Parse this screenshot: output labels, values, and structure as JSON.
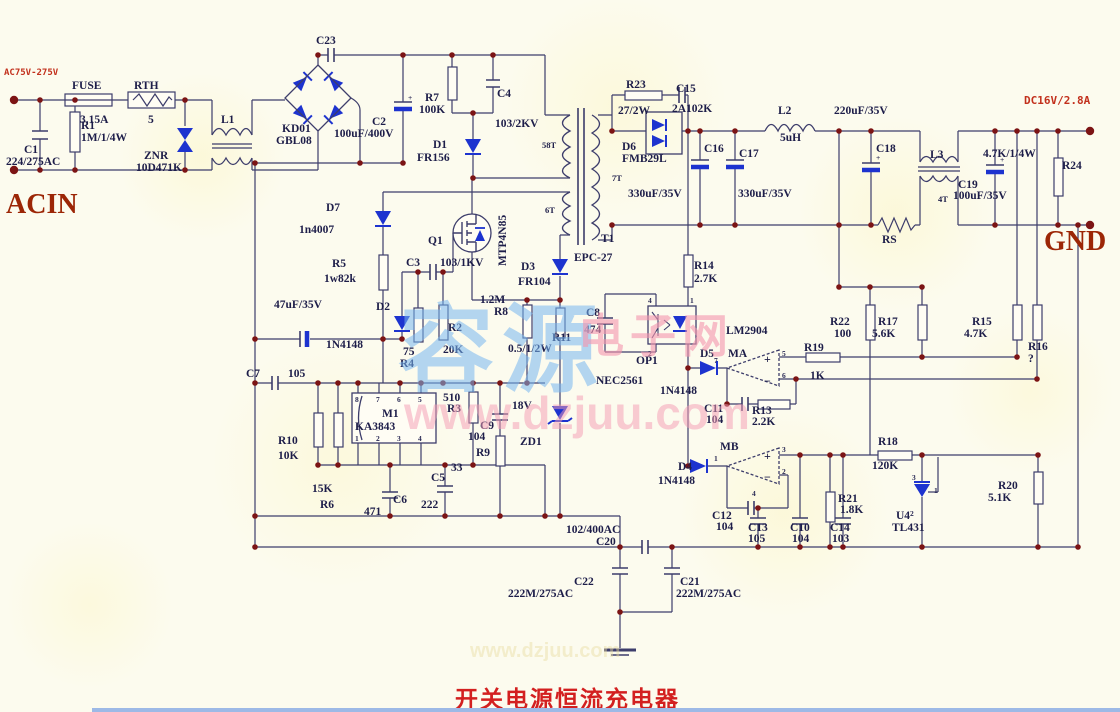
{
  "meta": {
    "title": "开关电源恒流充电器"
  },
  "watermark": {
    "cn1": "容源",
    "cn2": "电子网",
    "url": "www.dzjuu.com",
    "url_faint": "www.dzjuu.com"
  },
  "labels": [
    {
      "t": "AC75V-275V",
      "x": 4,
      "y": 75,
      "c": "rs"
    },
    {
      "t": "ACIN",
      "x": 6,
      "y": 213,
      "c": "rb"
    },
    {
      "t": "GND",
      "x": 1044,
      "y": 250,
      "c": "rb"
    },
    {
      "t": "DC16V/2.8A",
      "x": 1024,
      "y": 104,
      "c": "rs2"
    },
    {
      "t": "FUSE",
      "x": 72,
      "y": 89,
      "c": "c"
    },
    {
      "t": "3.15A",
      "x": 80,
      "y": 123,
      "c": "c"
    },
    {
      "t": "RTH",
      "x": 134,
      "y": 89,
      "c": "c"
    },
    {
      "t": "5",
      "x": 148,
      "y": 123,
      "c": "c"
    },
    {
      "t": "C1",
      "x": 24,
      "y": 153,
      "c": "c"
    },
    {
      "t": "224/275AC",
      "x": 6,
      "y": 165,
      "c": "c"
    },
    {
      "t": "R1",
      "x": 81,
      "y": 129,
      "c": "c"
    },
    {
      "t": "1M/1/4W",
      "x": 81,
      "y": 141,
      "c": "c"
    },
    {
      "t": "ZNR",
      "x": 144,
      "y": 159,
      "c": "c"
    },
    {
      "t": "10D471K",
      "x": 136,
      "y": 171,
      "c": "c"
    },
    {
      "t": "L1",
      "x": 221,
      "y": 123,
      "c": "c"
    },
    {
      "t": "C23",
      "x": 316,
      "y": 44,
      "c": "c"
    },
    {
      "t": "KD01",
      "x": 282,
      "y": 132,
      "c": "c"
    },
    {
      "t": "GBL08",
      "x": 276,
      "y": 144,
      "c": "c"
    },
    {
      "t": "C2",
      "x": 372,
      "y": 125,
      "c": "c"
    },
    {
      "t": "100uF/400V",
      "x": 334,
      "y": 137,
      "c": "c"
    },
    {
      "t": "R7",
      "x": 425,
      "y": 101,
      "c": "c"
    },
    {
      "t": "100K",
      "x": 419,
      "y": 113,
      "c": "c"
    },
    {
      "t": "C4",
      "x": 497,
      "y": 97,
      "c": "c"
    },
    {
      "t": "103/2KV",
      "x": 495,
      "y": 127,
      "c": "c"
    },
    {
      "t": "D1",
      "x": 433,
      "y": 148,
      "c": "c"
    },
    {
      "t": "FR156",
      "x": 417,
      "y": 161,
      "c": "c"
    },
    {
      "t": "D7",
      "x": 326,
      "y": 211,
      "c": "c"
    },
    {
      "t": "1n4007",
      "x": 299,
      "y": 233,
      "c": "c"
    },
    {
      "t": "R5",
      "x": 332,
      "y": 267,
      "c": "c"
    },
    {
      "t": "1w82k",
      "x": 324,
      "y": 282,
      "c": "c"
    },
    {
      "t": "47uF/35V",
      "x": 274,
      "y": 308,
      "c": "c"
    },
    {
      "t": "D2",
      "x": 376,
      "y": 310,
      "c": "c"
    },
    {
      "t": "1N4148",
      "x": 326,
      "y": 348,
      "c": "c"
    },
    {
      "t": "C3",
      "x": 406,
      "y": 266,
      "c": "c"
    },
    {
      "t": "103/1KV",
      "x": 440,
      "y": 266,
      "c": "c"
    },
    {
      "t": "Q1",
      "x": 428,
      "y": 244,
      "c": "c"
    },
    {
      "t": "MTP4N85",
      "x": 506,
      "y": 266,
      "c": "c",
      "r": -90
    },
    {
      "t": "1.2M",
      "x": 480,
      "y": 303,
      "c": "c"
    },
    {
      "t": "R8",
      "x": 494,
      "y": 315,
      "c": "c"
    },
    {
      "t": "R2",
      "x": 448,
      "y": 331,
      "c": "c"
    },
    {
      "t": "20K",
      "x": 443,
      "y": 353,
      "c": "c"
    },
    {
      "t": "75",
      "x": 403,
      "y": 355,
      "c": "c"
    },
    {
      "t": "R4",
      "x": 400,
      "y": 367,
      "c": "c"
    },
    {
      "t": "R11",
      "x": 552,
      "y": 341,
      "c": "c"
    },
    {
      "t": "0.5/1/2W",
      "x": 508,
      "y": 352,
      "c": "c"
    },
    {
      "t": "D3",
      "x": 521,
      "y": 270,
      "c": "c"
    },
    {
      "t": "FR104",
      "x": 518,
      "y": 285,
      "c": "c"
    },
    {
      "t": "58T",
      "x": 542,
      "y": 148,
      "c": "s"
    },
    {
      "t": "6T",
      "x": 545,
      "y": 213,
      "c": "s"
    },
    {
      "t": "7T",
      "x": 612,
      "y": 181,
      "c": "s"
    },
    {
      "t": "T1",
      "x": 601,
      "y": 242,
      "c": "c"
    },
    {
      "t": "EPC-27",
      "x": 574,
      "y": 261,
      "c": "c"
    },
    {
      "t": "C7",
      "x": 246,
      "y": 377,
      "c": "c"
    },
    {
      "t": "105",
      "x": 288,
      "y": 377,
      "c": "c"
    },
    {
      "t": "R10",
      "x": 278,
      "y": 444,
      "c": "c"
    },
    {
      "t": "10K",
      "x": 278,
      "y": 459,
      "c": "c"
    },
    {
      "t": "15K",
      "x": 312,
      "y": 492,
      "c": "c"
    },
    {
      "t": "R6",
      "x": 320,
      "y": 508,
      "c": "c"
    },
    {
      "t": "M1",
      "x": 382,
      "y": 417,
      "c": "c"
    },
    {
      "t": "KA3843",
      "x": 355,
      "y": 430,
      "c": "c"
    },
    {
      "t": "C6",
      "x": 393,
      "y": 503,
      "c": "c"
    },
    {
      "t": "471",
      "x": 364,
      "y": 515,
      "c": "c"
    },
    {
      "t": "C5",
      "x": 431,
      "y": 481,
      "c": "c"
    },
    {
      "t": "222",
      "x": 421,
      "y": 508,
      "c": "c"
    },
    {
      "t": "510",
      "x": 443,
      "y": 401,
      "c": "c"
    },
    {
      "t": "R3",
      "x": 447,
      "y": 412,
      "c": "c"
    },
    {
      "t": "C9",
      "x": 480,
      "y": 429,
      "c": "c"
    },
    {
      "t": "104",
      "x": 468,
      "y": 440,
      "c": "c"
    },
    {
      "t": "R9",
      "x": 476,
      "y": 456,
      "c": "c"
    },
    {
      "t": "33",
      "x": 451,
      "y": 471,
      "c": "c"
    },
    {
      "t": "18V",
      "x": 512,
      "y": 409,
      "c": "c"
    },
    {
      "t": "ZD1",
      "x": 520,
      "y": 445,
      "c": "c"
    },
    {
      "t": "102/400AC",
      "x": 566,
      "y": 533,
      "c": "c"
    },
    {
      "t": "C20",
      "x": 596,
      "y": 545,
      "c": "c"
    },
    {
      "t": "C22",
      "x": 574,
      "y": 585,
      "c": "c"
    },
    {
      "t": "222M/275AC",
      "x": 508,
      "y": 597,
      "c": "c"
    },
    {
      "t": "C21",
      "x": 680,
      "y": 585,
      "c": "c"
    },
    {
      "t": "222M/275AC",
      "x": 676,
      "y": 597,
      "c": "c"
    },
    {
      "t": "R23",
      "x": 626,
      "y": 88,
      "c": "c"
    },
    {
      "t": "27/2W",
      "x": 618,
      "y": 114,
      "c": "c"
    },
    {
      "t": "C15",
      "x": 676,
      "y": 92,
      "c": "c"
    },
    {
      "t": "2A102K",
      "x": 672,
      "y": 112,
      "c": "c"
    },
    {
      "t": "D6",
      "x": 622,
      "y": 150,
      "c": "c"
    },
    {
      "t": "FMB29L",
      "x": 622,
      "y": 162,
      "c": "c"
    },
    {
      "t": "C16",
      "x": 704,
      "y": 152,
      "c": "c"
    },
    {
      "t": "330uF/35V",
      "x": 628,
      "y": 197,
      "c": "c"
    },
    {
      "t": "C17",
      "x": 739,
      "y": 157,
      "c": "c"
    },
    {
      "t": "330uF/35V",
      "x": 738,
      "y": 197,
      "c": "c"
    },
    {
      "t": "L2",
      "x": 778,
      "y": 114,
      "c": "c"
    },
    {
      "t": "5uH",
      "x": 780,
      "y": 141,
      "c": "c"
    },
    {
      "t": "220uF/35V",
      "x": 834,
      "y": 114,
      "c": "c"
    },
    {
      "t": "C18",
      "x": 876,
      "y": 152,
      "c": "c"
    },
    {
      "t": "L3",
      "x": 930,
      "y": 158,
      "c": "c"
    },
    {
      "t": "4T",
      "x": 938,
      "y": 202,
      "c": "s"
    },
    {
      "t": "C19",
      "x": 958,
      "y": 188,
      "c": "c"
    },
    {
      "t": "100uF/35V",
      "x": 953,
      "y": 199,
      "c": "c"
    },
    {
      "t": "4.7K/1/4W",
      "x": 983,
      "y": 157,
      "c": "c"
    },
    {
      "t": "R24",
      "x": 1062,
      "y": 169,
      "c": "c"
    },
    {
      "t": "RS",
      "x": 882,
      "y": 243,
      "c": "c"
    },
    {
      "t": "R14",
      "x": 694,
      "y": 269,
      "c": "c"
    },
    {
      "t": "2.7K",
      "x": 694,
      "y": 282,
      "c": "c"
    },
    {
      "t": "C8",
      "x": 586,
      "y": 316,
      "c": "c"
    },
    {
      "t": "474",
      "x": 584,
      "y": 333,
      "c": "c"
    },
    {
      "t": "OP1",
      "x": 636,
      "y": 364,
      "c": "c"
    },
    {
      "t": "NEC2561",
      "x": 596,
      "y": 384,
      "c": "c"
    },
    {
      "t": "D5",
      "x": 700,
      "y": 357,
      "c": "c"
    },
    {
      "t": "1N4148",
      "x": 660,
      "y": 394,
      "c": "c"
    },
    {
      "t": "MA",
      "x": 728,
      "y": 357,
      "c": "c"
    },
    {
      "t": "LM2904",
      "x": 726,
      "y": 334,
      "c": "c"
    },
    {
      "t": "R19",
      "x": 804,
      "y": 351,
      "c": "c"
    },
    {
      "t": "1K",
      "x": 810,
      "y": 379,
      "c": "c"
    },
    {
      "t": "R22",
      "x": 830,
      "y": 325,
      "c": "c"
    },
    {
      "t": "100",
      "x": 834,
      "y": 337,
      "c": "c"
    },
    {
      "t": "R17",
      "x": 878,
      "y": 325,
      "c": "c"
    },
    {
      "t": "5.6K",
      "x": 872,
      "y": 337,
      "c": "c"
    },
    {
      "t": "R15",
      "x": 972,
      "y": 325,
      "c": "c"
    },
    {
      "t": "4.7K",
      "x": 964,
      "y": 337,
      "c": "c"
    },
    {
      "t": "R16",
      "x": 1028,
      "y": 350,
      "c": "c"
    },
    {
      "t": "?",
      "x": 1028,
      "y": 362,
      "c": "c"
    },
    {
      "t": "C11",
      "x": 704,
      "y": 412,
      "c": "c"
    },
    {
      "t": "104",
      "x": 706,
      "y": 423,
      "c": "c"
    },
    {
      "t": "R13",
      "x": 752,
      "y": 414,
      "c": "c"
    },
    {
      "t": "2.2K",
      "x": 752,
      "y": 425,
      "c": "c"
    },
    {
      "t": "MB",
      "x": 720,
      "y": 450,
      "c": "c"
    },
    {
      "t": "D4",
      "x": 678,
      "y": 470,
      "c": "c"
    },
    {
      "t": "1N4148",
      "x": 658,
      "y": 484,
      "c": "c"
    },
    {
      "t": "C12",
      "x": 712,
      "y": 519,
      "c": "c"
    },
    {
      "t": "104",
      "x": 716,
      "y": 530,
      "c": "c"
    },
    {
      "t": "R18",
      "x": 878,
      "y": 445,
      "c": "c"
    },
    {
      "t": "120K",
      "x": 872,
      "y": 469,
      "c": "c"
    },
    {
      "t": "R21",
      "x": 838,
      "y": 502,
      "c": "c"
    },
    {
      "t": "1.8K",
      "x": 840,
      "y": 513,
      "c": "c"
    },
    {
      "t": "C13",
      "x": 748,
      "y": 531,
      "c": "c"
    },
    {
      "t": "105",
      "x": 748,
      "y": 542,
      "c": "c"
    },
    {
      "t": "C10",
      "x": 790,
      "y": 531,
      "c": "c"
    },
    {
      "t": "104",
      "x": 792,
      "y": 542,
      "c": "c"
    },
    {
      "t": "C14",
      "x": 830,
      "y": 531,
      "c": "c"
    },
    {
      "t": "103",
      "x": 832,
      "y": 542,
      "c": "c"
    },
    {
      "t": "U4",
      "x": 896,
      "y": 519,
      "c": "c"
    },
    {
      "t": "TL431",
      "x": 892,
      "y": 531,
      "c": "c"
    },
    {
      "t": "R20",
      "x": 998,
      "y": 489,
      "c": "c"
    },
    {
      "t": "5.1K",
      "x": 988,
      "y": 501,
      "c": "c"
    },
    {
      "t": "8",
      "x": 355,
      "y": 402,
      "c": "p"
    },
    {
      "t": "7",
      "x": 376,
      "y": 402,
      "c": "p"
    },
    {
      "t": "6",
      "x": 397,
      "y": 402,
      "c": "p"
    },
    {
      "t": "5",
      "x": 418,
      "y": 402,
      "c": "p"
    },
    {
      "t": "1",
      "x": 355,
      "y": 441,
      "c": "p"
    },
    {
      "t": "2",
      "x": 376,
      "y": 441,
      "c": "p"
    },
    {
      "t": "3",
      "x": 397,
      "y": 441,
      "c": "p"
    },
    {
      "t": "4",
      "x": 418,
      "y": 441,
      "c": "p"
    },
    {
      "t": "5",
      "x": 782,
      "y": 356,
      "c": "p"
    },
    {
      "t": "6",
      "x": 782,
      "y": 378,
      "c": "p"
    },
    {
      "t": "7",
      "x": 714,
      "y": 363,
      "c": "p"
    },
    {
      "t": "3",
      "x": 782,
      "y": 452,
      "c": "p"
    },
    {
      "t": "2",
      "x": 782,
      "y": 474,
      "c": "p"
    },
    {
      "t": "1",
      "x": 714,
      "y": 461,
      "c": "p"
    },
    {
      "t": "4",
      "x": 752,
      "y": 496,
      "c": "p"
    },
    {
      "t": "4",
      "x": 648,
      "y": 303,
      "c": "p"
    },
    {
      "t": "1",
      "x": 690,
      "y": 303,
      "c": "p"
    },
    {
      "t": "2",
      "x": 648,
      "y": 356,
      "c": "p"
    },
    {
      "t": "3",
      "x": 912,
      "y": 480,
      "c": "p"
    },
    {
      "t": "1",
      "x": 934,
      "y": 493,
      "c": "p"
    },
    {
      "t": "2",
      "x": 910,
      "y": 516,
      "c": "p"
    },
    {
      "t": "+",
      "x": 408,
      "y": 100,
      "c": "p"
    },
    {
      "t": "+",
      "x": 876,
      "y": 160,
      "c": "p"
    },
    {
      "t": "+",
      "x": 1000,
      "y": 162,
      "c": "p"
    },
    {
      "t": "+",
      "x": 764,
      "y": 363,
      "c": "op"
    },
    {
      "t": "−",
      "x": 764,
      "y": 385,
      "c": "op"
    },
    {
      "t": "+",
      "x": 764,
      "y": 460,
      "c": "op"
    },
    {
      "t": "−",
      "x": 764,
      "y": 481,
      "c": "op"
    }
  ]
}
